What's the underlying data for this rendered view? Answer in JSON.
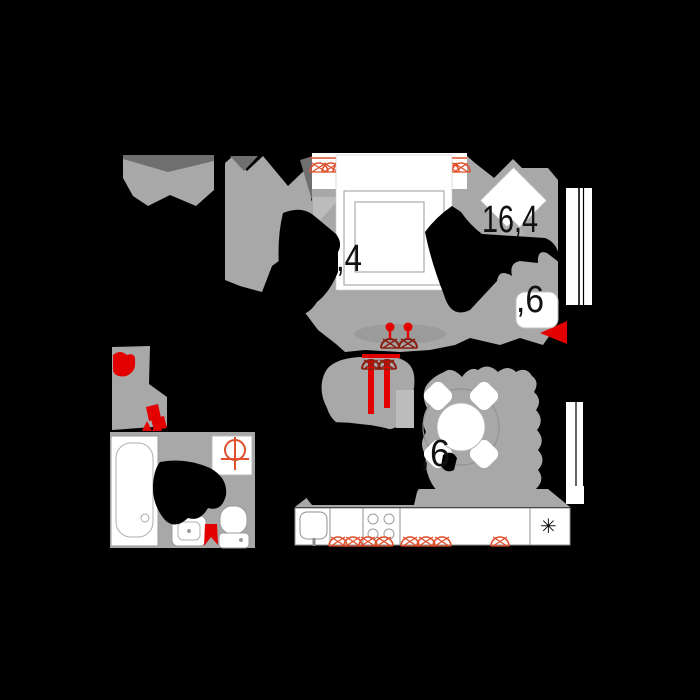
{
  "title": "apartment-floor-plan",
  "background_color": "#000000",
  "colors": {
    "floor_gray": "#a8a8a8",
    "floor_dark_gray": "#6f6f6f",
    "floor_light_gray": "#bcbcbc",
    "furniture_white": "#ffffff",
    "outline_gray": "#8f8f8f",
    "accent_red": "#e30000",
    "accent_dark_red": "#8b2012",
    "symbol_orange": "#e0502d",
    "label_text": "#111111"
  },
  "area_labels": [
    {
      "room": "living-room",
      "text": "16,4"
    },
    {
      "room": "bed-zone",
      "text": ",4"
    },
    {
      "room": "pouf-zone",
      "text": ",6"
    },
    {
      "room": "kitchen-zone",
      "text": ",6"
    }
  ],
  "icons": {
    "fridge": "✳"
  },
  "furniture_items": [
    "double-bed",
    "pillows",
    "armchair",
    "pouf",
    "rug",
    "dining-table",
    "dining-chairs",
    "kitchen-counter",
    "kitchen-sink",
    "stove-burners",
    "fridge",
    "bathtub",
    "washbasin",
    "toilet",
    "washing-machine",
    "red-plants",
    "wall-light-symbols",
    "window-glazing",
    "balcony-railing"
  ]
}
